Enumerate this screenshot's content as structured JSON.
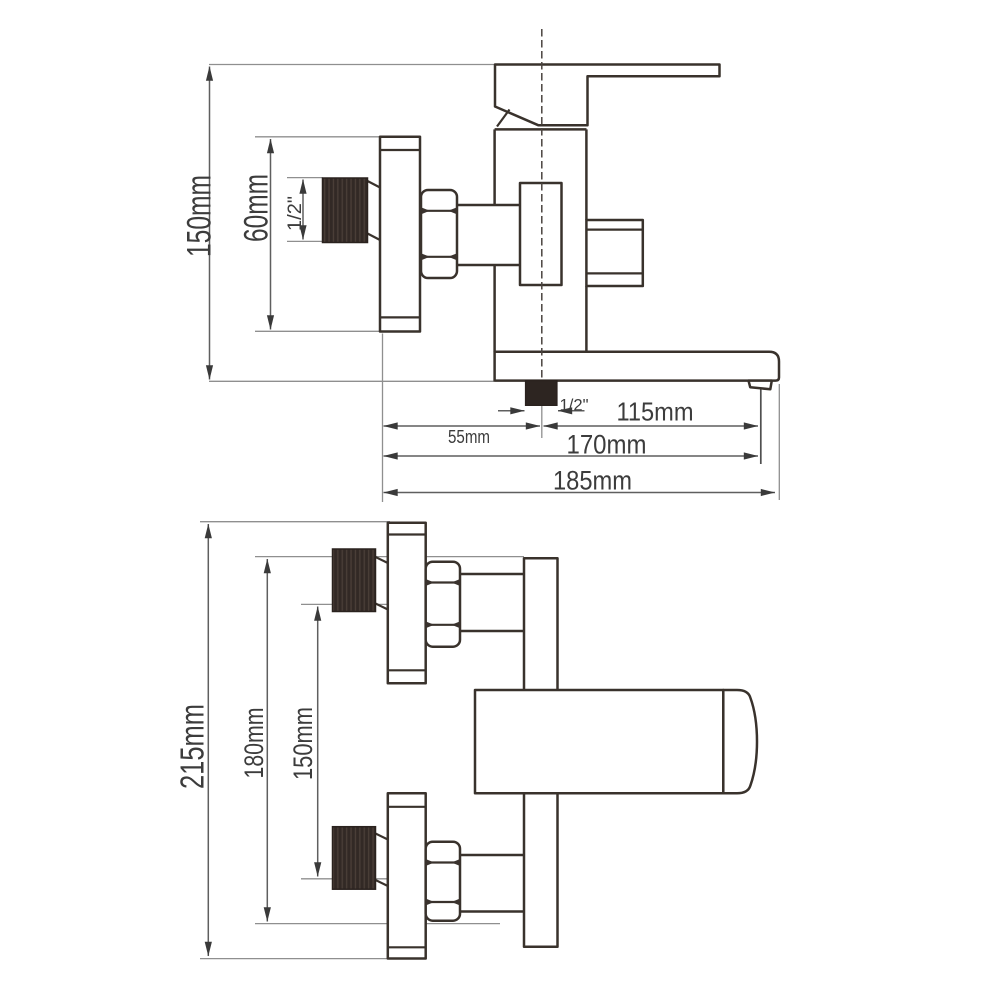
{
  "side_view": {
    "height_label": "150mm",
    "escutcheon_label": "60mm",
    "side_thread_label": "1/2\"",
    "bottom_thread_label": "1/2\"",
    "reach_115_label": "115mm",
    "offset_55_label": "55mm",
    "reach_170_label": "170mm",
    "reach_185_label": "185mm"
  },
  "plan_view": {
    "width_215_label": "215mm",
    "width_180_label": "180mm",
    "centers_150_label": "150mm"
  },
  "colors": {
    "background": "#ffffff",
    "outline": "#39322c",
    "dimension_line": "#5f5f5f",
    "extension_line": "#8f8f8f",
    "arrowhead": "#3a3a3a",
    "label_text": "#3c3c3c",
    "connector_fill": "#302823"
  }
}
